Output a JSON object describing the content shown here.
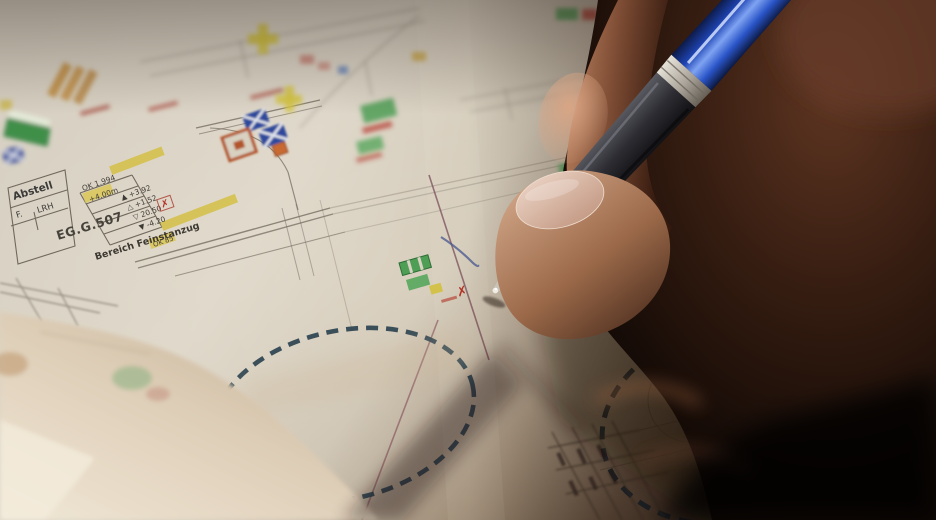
{
  "photo": {
    "subject": "Close-up of a hand writing with a blue ballpoint pen on an architectural floor plan annotated with colored highlighter marks; two areas are circled with dashed marker lines",
    "colors": {
      "paper": "#d9d2c4",
      "paper_shadow": "#2e211a",
      "highlighter_yellow": "#d3bf45",
      "marker_green": "#4f9e55",
      "marker_red": "#b23326",
      "marker_blue": "#2d4a9c",
      "marker_orange": "#b2542c",
      "circle_ink": "#2c4350",
      "pen_barrel_blue": "#2b57d6",
      "pen_grip": "#2c2c32",
      "pen_tip_silver": "#c8c2b6",
      "skin_highlight": "#d4a98c",
      "skin_shadow": "#351c10"
    },
    "plan": {
      "room_table": {
        "row1": "Abstell",
        "row2": "F.",
        "row3": "LRH",
        "room_id": "EG.G.507",
        "area_label": "Bereich Feinstanzug"
      },
      "elevation_block": {
        "line1": "OK 1.994",
        "line2": "+4.00m",
        "line3": "▲ +3.92",
        "line4": "△ +1.52",
        "line5": "▽ 20.50",
        "line6": "▼ -4.20",
        "reject_mark": "✗"
      },
      "note_block": "OK 85",
      "reject_mark2": "✗"
    }
  }
}
